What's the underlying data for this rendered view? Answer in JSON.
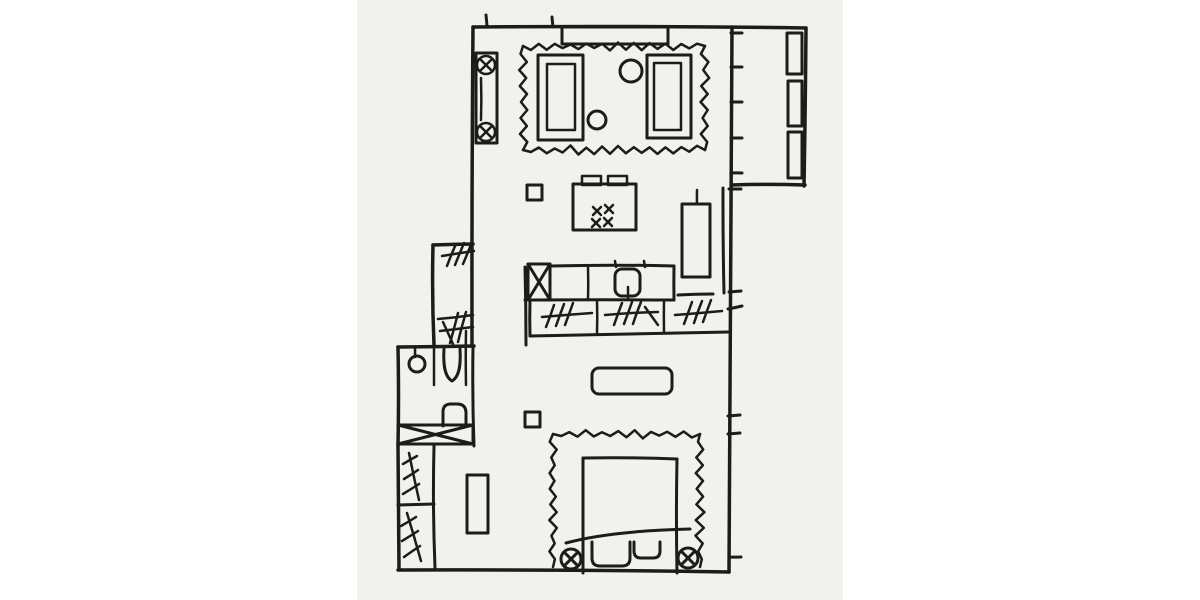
{
  "meta": {
    "description": "Hand-drawn one-bedroom apartment floor plan sketch with living area, kitchen, bathroom, closets, bedroom and balcony",
    "canvas": {
      "width": 1200,
      "height": 600
    },
    "panel": {
      "x": 357,
      "y": 0,
      "width": 486,
      "height": 600
    },
    "colors": {
      "page_background": "#ffffff",
      "panel_background": "#f1f1ee",
      "ink": "#1c1c1a"
    },
    "stroke": {
      "wall": 3.5,
      "furniture": 3,
      "detail": 2.5
    }
  },
  "elements": [
    {
      "name": "top-wall",
      "type": "line",
      "sw": 3.5,
      "p": [
        473,
        27,
        806,
        28
      ]
    },
    {
      "name": "left-wall",
      "type": "line",
      "sw": 3.5,
      "p": [
        473,
        27,
        472,
        346
      ]
    },
    {
      "name": "nook-top-wall",
      "type": "line",
      "sw": 3.5,
      "p": [
        433,
        245,
        473,
        244
      ]
    },
    {
      "name": "nook-left-wall",
      "type": "line",
      "sw": 3.5,
      "p": [
        433,
        245,
        434,
        345
      ]
    },
    {
      "name": "bathroom-top-wall",
      "type": "line",
      "sw": 3.5,
      "p": [
        398,
        347,
        474,
        346
      ]
    },
    {
      "name": "bathroom-left-wall",
      "type": "line",
      "sw": 3.5,
      "p": [
        398,
        347,
        398,
        446
      ]
    },
    {
      "name": "bathroom-right-wall",
      "type": "line",
      "sw": 3,
      "p": [
        473,
        347,
        474,
        446
      ]
    },
    {
      "name": "closet-left-wall",
      "type": "line",
      "sw": 3.5,
      "p": [
        398,
        446,
        399,
        569
      ]
    },
    {
      "name": "bottom-wall",
      "type": "line",
      "sw": 3.5,
      "p": [
        398,
        570,
        729,
        572
      ]
    },
    {
      "name": "right-wall",
      "type": "line",
      "sw": 3.5,
      "p": [
        732,
        27,
        729,
        572
      ]
    },
    {
      "name": "balcony-right-wall",
      "type": "line",
      "sw": 3.5,
      "p": [
        806,
        28,
        804,
        186
      ]
    },
    {
      "name": "balcony-bottom-wall",
      "type": "line",
      "sw": 3.5,
      "p": [
        732,
        185,
        805,
        185
      ]
    },
    {
      "name": "kitchen-inner-wall",
      "type": "line",
      "sw": 3,
      "p": [
        723,
        188,
        724,
        293
      ]
    },
    {
      "name": "kitchen-peninsula-wall",
      "type": "line",
      "sw": 3,
      "p": [
        525,
        267,
        526,
        345
      ]
    },
    {
      "name": "closet-right-wall",
      "type": "line",
      "sw": 3,
      "p": [
        434,
        446,
        435,
        568
      ]
    },
    {
      "name": "closet-shelf-divider",
      "type": "line",
      "sw": 3,
      "p": [
        398,
        505,
        434,
        504
      ]
    },
    {
      "name": "top-wall-tick-a",
      "type": "line",
      "sw": 3,
      "p": [
        486,
        15,
        487,
        26
      ]
    },
    {
      "name": "top-wall-tick-b",
      "type": "line",
      "sw": 3,
      "p": [
        552,
        17,
        553,
        27
      ]
    },
    {
      "name": "window-mullion-tick-1",
      "type": "line",
      "sw": 3,
      "p": [
        731,
        33,
        742,
        33
      ]
    },
    {
      "name": "window-mullion-tick-2",
      "type": "line",
      "sw": 3,
      "p": [
        731,
        67,
        742,
        67
      ]
    },
    {
      "name": "window-mullion-tick-3",
      "type": "line",
      "sw": 3,
      "p": [
        731,
        102,
        742,
        102
      ]
    },
    {
      "name": "window-mullion-tick-4",
      "type": "line",
      "sw": 3,
      "p": [
        731,
        138,
        742,
        138
      ]
    },
    {
      "name": "window-mullion-tick-5",
      "type": "line",
      "sw": 3,
      "p": [
        731,
        173,
        742,
        173
      ]
    },
    {
      "name": "wall-tick-1",
      "type": "line",
      "sw": 3,
      "p": [
        729,
        189,
        741,
        189
      ]
    },
    {
      "name": "wall-tick-2",
      "type": "line",
      "sw": 3,
      "p": [
        729,
        292,
        741,
        291
      ]
    },
    {
      "name": "wall-tick-3",
      "type": "line",
      "sw": 3,
      "p": [
        728,
        309,
        742,
        306
      ]
    },
    {
      "name": "wall-tick-4",
      "type": "line",
      "sw": 3,
      "p": [
        728,
        416,
        740,
        415
      ]
    },
    {
      "name": "wall-tick-5",
      "type": "line",
      "sw": 3,
      "p": [
        728,
        434,
        740,
        433
      ]
    },
    {
      "name": "wall-tick-6",
      "type": "line",
      "sw": 3,
      "p": [
        729,
        557,
        741,
        557
      ]
    },
    {
      "name": "window-console",
      "type": "rect",
      "sw": 3,
      "p": [
        562,
        27,
        106,
        17
      ]
    },
    {
      "name": "radiator-body",
      "type": "rect",
      "sw": 3,
      "p": [
        476,
        53,
        21,
        90
      ]
    },
    {
      "name": "radiator-valve-top",
      "type": "xcircle",
      "sw": 2.5,
      "p": [
        486,
        65,
        9
      ]
    },
    {
      "name": "radiator-valve-bottom",
      "type": "xcircle",
      "sw": 2.5,
      "p": [
        486,
        132,
        9
      ]
    },
    {
      "name": "radiator-line",
      "type": "line",
      "sw": 2.5,
      "p": [
        481,
        78,
        481,
        120
      ]
    },
    {
      "name": "living-room-rug",
      "type": "zigzag",
      "sw": 2.5,
      "amp": 3,
      "step": 8,
      "segs": [
        [
          523,
          46,
          705,
          46
        ],
        [
          705,
          46,
          705,
          150
        ],
        [
          705,
          150,
          523,
          150
        ],
        [
          523,
          150,
          523,
          46
        ]
      ]
    },
    {
      "name": "armchair-left-outer",
      "type": "rect",
      "sw": 3,
      "p": [
        538,
        55,
        45,
        85
      ]
    },
    {
      "name": "armchair-left-inner",
      "type": "rect",
      "sw": 2.5,
      "p": [
        547,
        64,
        28,
        66
      ]
    },
    {
      "name": "armchair-right-outer",
      "type": "rect",
      "sw": 3,
      "p": [
        647,
        55,
        44,
        83
      ]
    },
    {
      "name": "armchair-right-inner",
      "type": "rect",
      "sw": 2.5,
      "p": [
        654,
        63,
        27,
        67
      ]
    },
    {
      "name": "side-table-large",
      "type": "circle",
      "sw": 3,
      "p": [
        631,
        71,
        11
      ]
    },
    {
      "name": "side-table-small",
      "type": "circle",
      "sw": 3,
      "p": [
        597,
        120,
        9
      ]
    },
    {
      "name": "kitchen-island",
      "type": "rect",
      "sw": 3,
      "p": [
        573,
        184,
        63,
        46
      ]
    },
    {
      "name": "island-stool-left",
      "type": "rect",
      "sw": 2.5,
      "p": [
        582,
        176,
        19,
        9
      ]
    },
    {
      "name": "island-stool-right",
      "type": "rect",
      "sw": 2.5,
      "p": [
        608,
        176,
        19,
        9
      ]
    },
    {
      "name": "stove-burner-1",
      "type": "xmark",
      "sw": 2.5,
      "p": [
        597,
        211,
        4
      ]
    },
    {
      "name": "stove-burner-2",
      "type": "xmark",
      "sw": 2.5,
      "p": [
        609,
        209,
        4
      ]
    },
    {
      "name": "stove-burner-3",
      "type": "xmark",
      "sw": 2.5,
      "p": [
        596,
        223,
        4
      ]
    },
    {
      "name": "stove-burner-4",
      "type": "xmark",
      "sw": 2.5,
      "p": [
        608,
        222,
        4
      ]
    },
    {
      "name": "structural-column-top",
      "type": "rect",
      "sw": 3,
      "p": [
        527,
        185,
        15,
        15
      ]
    },
    {
      "name": "tall-cabinet",
      "type": "rect",
      "sw": 3,
      "p": [
        682,
        204,
        28,
        73
      ]
    },
    {
      "name": "tall-cabinet-handle",
      "type": "line",
      "sw": 2.5,
      "p": [
        697,
        190,
        697,
        204
      ]
    },
    {
      "name": "dishwasher",
      "type": "xrect",
      "sw": 3,
      "p": [
        528,
        264,
        22,
        36
      ]
    },
    {
      "name": "counter-top-edge",
      "type": "line",
      "sw": 3,
      "p": [
        550,
        266,
        674,
        266
      ]
    },
    {
      "name": "counter-right-edge",
      "type": "line",
      "sw": 3,
      "p": [
        674,
        266,
        674,
        300
      ]
    },
    {
      "name": "counter-mid-shelf",
      "type": "line",
      "sw": 3,
      "p": [
        525,
        300,
        674,
        300
      ]
    },
    {
      "name": "counter-divider",
      "type": "line",
      "sw": 2.5,
      "p": [
        588,
        267,
        588,
        300
      ]
    },
    {
      "name": "kitchen-sink",
      "type": "rect",
      "sw": 3,
      "p": [
        615,
        269,
        25,
        27
      ],
      "rx": 7
    },
    {
      "name": "sink-faucet",
      "type": "line",
      "sw": 2.5,
      "p": [
        628,
        287,
        628,
        299
      ]
    },
    {
      "name": "sink-tick-left",
      "type": "line",
      "sw": 2.5,
      "p": [
        615,
        261,
        616,
        267
      ]
    },
    {
      "name": "sink-tick-right",
      "type": "line",
      "sw": 2.5,
      "p": [
        644,
        261,
        645,
        267
      ]
    },
    {
      "name": "cabinet-under-fridge",
      "type": "line",
      "sw": 3,
      "p": [
        678,
        295,
        713,
        294
      ]
    },
    {
      "name": "drawer-unit-left",
      "type": "line",
      "sw": 3,
      "p": [
        530,
        300,
        530,
        336
      ]
    },
    {
      "name": "drawer-unit-bottom",
      "type": "line",
      "sw": 3,
      "p": [
        530,
        336,
        729,
        332
      ]
    },
    {
      "name": "drawer-divider-1",
      "type": "line",
      "sw": 2.5,
      "p": [
        597,
        300,
        597,
        334
      ]
    },
    {
      "name": "drawer-divider-2",
      "type": "line",
      "sw": 2.5,
      "p": [
        664,
        300,
        664,
        333
      ]
    },
    {
      "name": "drawer-hatch-1",
      "type": "multiline",
      "sw": 2.5,
      "lines": [
        [
          542,
          317,
          592,
          313
        ],
        [
          554,
          305,
          546,
          327
        ],
        [
          564,
          304,
          556,
          326
        ],
        [
          573,
          303,
          565,
          325
        ]
      ]
    },
    {
      "name": "drawer-hatch-2",
      "type": "multiline",
      "sw": 2.5,
      "lines": [
        [
          605,
          315,
          658,
          312
        ],
        [
          622,
          303,
          614,
          325
        ],
        [
          632,
          302,
          624,
          324
        ],
        [
          641,
          302,
          633,
          324
        ],
        [
          645,
          307,
          658,
          325
        ]
      ]
    },
    {
      "name": "drawer-hatch-3",
      "type": "multiline",
      "sw": 2.5,
      "lines": [
        [
          675,
          315,
          722,
          311
        ],
        [
          692,
          302,
          684,
          324
        ],
        [
          702,
          301,
          694,
          323
        ],
        [
          711,
          300,
          703,
          322
        ]
      ]
    },
    {
      "name": "nook-shelf-hatch-top",
      "type": "multiline",
      "sw": 2.5,
      "lines": [
        [
          442,
          256,
          474,
          251
        ],
        [
          456,
          244,
          447,
          266
        ],
        [
          464,
          243,
          455,
          265
        ],
        [
          472,
          242,
          463,
          264
        ]
      ]
    },
    {
      "name": "nook-shelf-line-mid",
      "type": "line",
      "sw": 2.5,
      "p": [
        438,
        319,
        473,
        315
      ]
    },
    {
      "name": "nook-shelf-hatch-bottom",
      "type": "multiline",
      "sw": 2.5,
      "lines": [
        [
          440,
          331,
          473,
          327
        ],
        [
          458,
          313,
          450,
          343
        ],
        [
          466,
          312,
          458,
          342
        ],
        [
          443,
          322,
          453,
          344
        ]
      ]
    },
    {
      "name": "pendant-cord",
      "type": "line",
      "sw": 2.5,
      "p": [
        415,
        347,
        415,
        357
      ]
    },
    {
      "name": "round-basin",
      "type": "circle",
      "sw": 3,
      "p": [
        417,
        364,
        8
      ]
    },
    {
      "name": "toilet-partition-left",
      "type": "line",
      "sw": 2.5,
      "p": [
        434,
        347,
        434,
        385
      ]
    },
    {
      "name": "toilet-bowl",
      "type": "path",
      "sw": 3,
      "d": "M444,349 C443,366 445,377 452,381 C459,377 461,366 460,349"
    },
    {
      "name": "toilet-partition-right",
      "type": "line",
      "sw": 2.5,
      "p": [
        466,
        331,
        466,
        385
      ]
    },
    {
      "name": "wall-sink",
      "type": "path",
      "sw": 3,
      "d": "M443,426 L443,412 Q443,404 451,404 L457,404 Q466,404 466,413 L466,426"
    },
    {
      "name": "bathtub",
      "type": "xrect",
      "sw": 3,
      "p": [
        398,
        425,
        75,
        19
      ]
    },
    {
      "name": "closet-rail-top",
      "type": "multiline",
      "sw": 2.5,
      "lines": [
        [
          409,
          453,
          419,
          500
        ],
        [
          403,
          464,
          417,
          456
        ],
        [
          404,
          479,
          418,
          470
        ],
        [
          403,
          494,
          419,
          484
        ]
      ]
    },
    {
      "name": "closet-rail-bottom",
      "type": "multiline",
      "sw": 2.5,
      "lines": [
        [
          407,
          513,
          421,
          561
        ],
        [
          401,
          526,
          416,
          517
        ],
        [
          402,
          541,
          418,
          531
        ],
        [
          404,
          557,
          420,
          546
        ]
      ]
    },
    {
      "name": "hall-console",
      "type": "rect",
      "sw": 3,
      "p": [
        467,
        475,
        21,
        58
      ]
    },
    {
      "name": "bedroom-bench",
      "type": "rect",
      "sw": 3,
      "p": [
        592,
        368,
        80,
        26
      ],
      "rx": 7
    },
    {
      "name": "structural-column-bottom",
      "type": "rect",
      "sw": 3,
      "p": [
        525,
        412,
        15,
        15
      ]
    },
    {
      "name": "bedroom-rug",
      "type": "zigzag",
      "sw": 2.5,
      "amp": 3,
      "step": 8,
      "segs": [
        [
          553,
          567,
          553,
          434
        ],
        [
          553,
          434,
          700,
          434
        ],
        [
          700,
          434,
          700,
          567
        ]
      ]
    },
    {
      "name": "bed",
      "type": "multiline",
      "sw": 3,
      "lines": [
        [
          583,
          458,
          583,
          573
        ],
        [
          583,
          458,
          677,
          459
        ],
        [
          677,
          459,
          677,
          573
        ]
      ]
    },
    {
      "name": "blanket-line",
      "type": "path",
      "sw": 3,
      "d": "M566,543 Q610,531 690,529"
    },
    {
      "name": "pillow-left",
      "type": "path",
      "sw": 3,
      "d": "M592,542 L592,558 Q592,566 600,566 L622,566 Q630,566 630,558 L630,542"
    },
    {
      "name": "pillow-right",
      "type": "path",
      "sw": 3,
      "d": "M634,542 L634,551 Q634,558 641,558 L653,558 Q660,558 660,551 L660,542"
    },
    {
      "name": "bedside-lamp-left",
      "type": "xcircle",
      "sw": 3,
      "p": [
        571,
        559,
        10
      ]
    },
    {
      "name": "bedside-lamp-right",
      "type": "xcircle",
      "sw": 3,
      "p": [
        688,
        558,
        10
      ]
    },
    {
      "name": "balcony-planter-1",
      "type": "rect",
      "sw": 3,
      "p": [
        787,
        33,
        15,
        41
      ]
    },
    {
      "name": "balcony-planter-2",
      "type": "rect",
      "sw": 3,
      "p": [
        788,
        81,
        14,
        45
      ]
    },
    {
      "name": "balcony-planter-3",
      "type": "rect",
      "sw": 3,
      "p": [
        788,
        132,
        14,
        46
      ]
    }
  ]
}
